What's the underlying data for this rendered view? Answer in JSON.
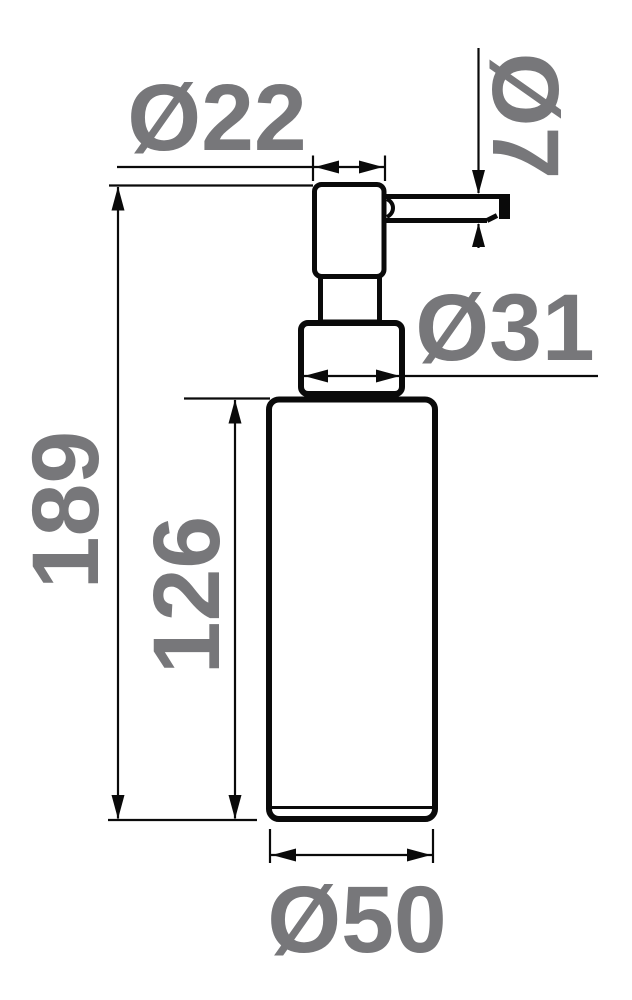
{
  "drawing": {
    "subject": "soap-dispenser-dimension-drawing",
    "labels": {
      "pump_head_diameter": "Ø22",
      "spout_diameter": "Ø7",
      "collar_diameter": "Ø31",
      "total_height": "189",
      "body_height": "126",
      "body_diameter": "Ø50"
    },
    "colors": {
      "line": "#0a0a0a",
      "label": "#77777a",
      "background": "#ffffff"
    }
  }
}
